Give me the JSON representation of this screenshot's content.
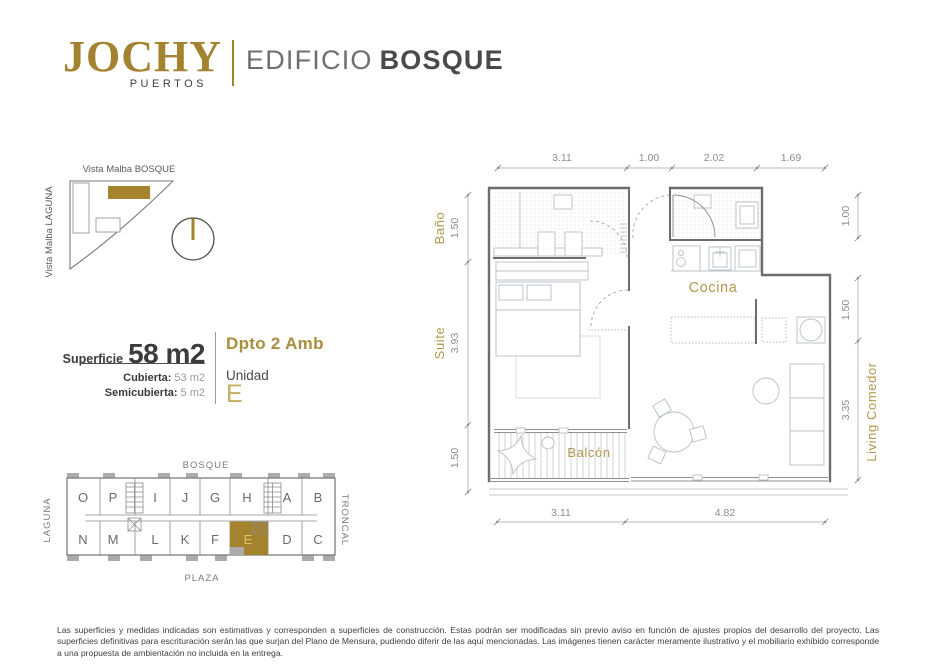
{
  "colors": {
    "gold": "#A3832F",
    "gold_soft": "#B0984C",
    "dark": "#4A4A48"
  },
  "header": {
    "logo": "JOCHY",
    "logo_sub": "PUERTOS",
    "edificio": "EDIFICIO",
    "bosque": "BOSQUE"
  },
  "siteplan": {
    "top_label": "Vista Malba BOSQUE",
    "left_label": "Vista Malba LAGUNA"
  },
  "info": {
    "superficie_label": "Superficie",
    "superficie_value": "58 m2",
    "cubierta_label": "Cubierta:",
    "cubierta_value": "53 m2",
    "semicubierta_label": "Semicubierta:",
    "semicubierta_value": "5 m2",
    "tipo": "Dpto 2 Amb",
    "unidad_label": "Unidad",
    "unidad_value": "E"
  },
  "keyplan": {
    "bosque": "BOSQUE",
    "plaza": "PLAZA",
    "laguna": "LAGUNA",
    "troncal": "TRONCAL",
    "top_row": [
      "O",
      "P",
      "I",
      "J",
      "G",
      "H",
      "A",
      "B"
    ],
    "bottom_row": [
      "N",
      "M",
      "L",
      "K",
      "F",
      "E",
      "D",
      "C"
    ],
    "highlight": "E"
  },
  "plan": {
    "rooms": {
      "bano": "Baño",
      "suite": "Suite",
      "cocina": "Cocina",
      "living": "Living Comedor",
      "balcon": "Balcón"
    },
    "dims": {
      "top": [
        "3.11",
        "1.00",
        "2.02",
        "1.69"
      ],
      "bottom": [
        "3.11",
        "4.82"
      ],
      "left": [
        "1.50",
        "3.93",
        "1.50"
      ],
      "right": [
        "1.00",
        "1.50",
        "3.35"
      ]
    }
  },
  "disclaimer": "Las superficies y medidas indicadas son estimativas y corresponden a superficies de construcción. Estas podrán ser modificadas sin previo aviso en función de ajustes propios del desarrollo del proyecto. Las superficies definitivas para escrituración serán las que surjan del Plano de Mensura, pudiendo diferir de las aquí mencionadas. Las imágenes tienen carácter meramente ilustrativo y el mobiliario exhibido corresponde a una propuesta de ambientación no incluida en la entrega."
}
